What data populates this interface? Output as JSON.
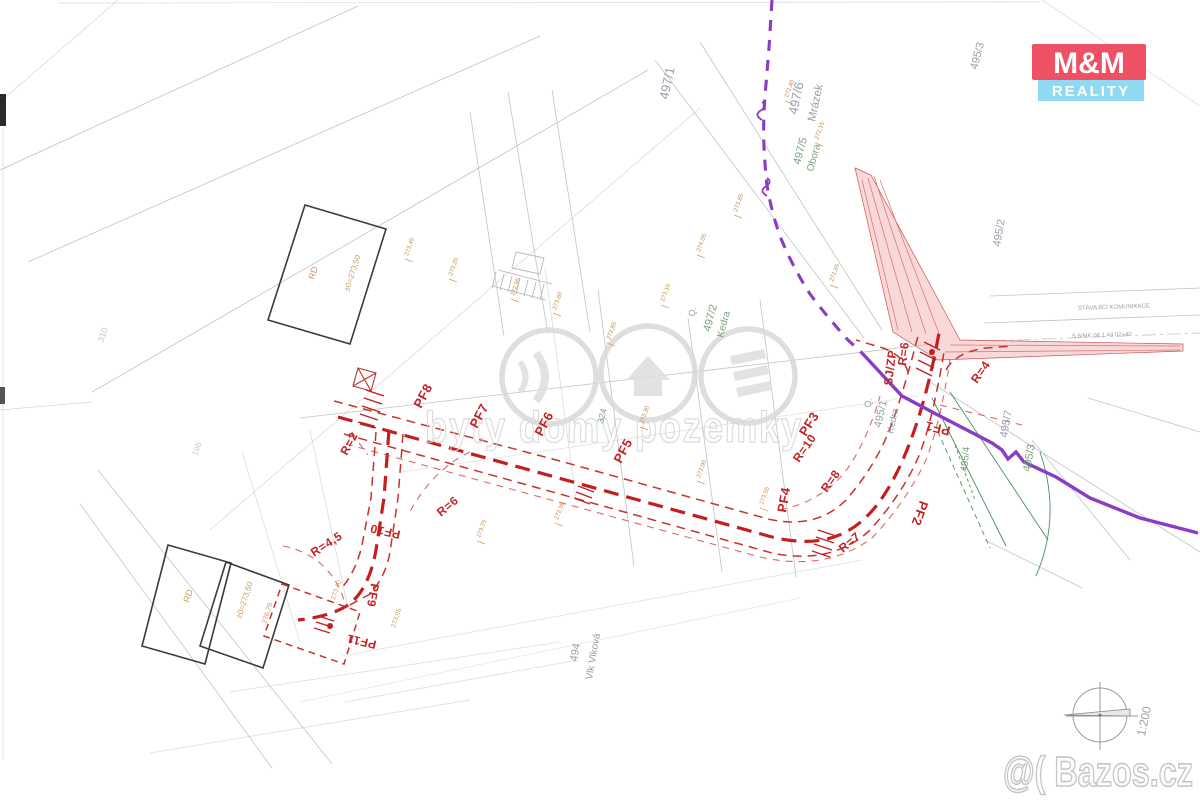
{
  "title": "Scanned cadastral site plan with road design (real-estate listing image)",
  "logo": {
    "line1": "M&M",
    "line2": "REALITY"
  },
  "watermark": {
    "center": "byty domy pozemky",
    "corner": "@( Bazos.cz"
  },
  "scale_label": "1:200",
  "colors": {
    "design_red": "#c41f1f",
    "utility_purple": "#8a3cc2",
    "wedge_pink": "#f0a8a8",
    "vegetation_green": "#4e8d58",
    "parcel_gray": "#98a0ab",
    "logo_red": "#ee5164",
    "logo_cyan": "#8fd9f2"
  },
  "map_labels": {
    "parcel": [
      {
        "t": "497/1",
        "x": 668,
        "y": 100,
        "r": -78,
        "s": 13,
        "c": "lblG"
      },
      {
        "t": "497/6",
        "x": 797,
        "y": 115,
        "r": -78,
        "s": 13,
        "c": "lblG"
      },
      {
        "t": "Mrázek",
        "x": 815,
        "y": 122,
        "r": -78,
        "s": 11.5,
        "c": "lblG"
      },
      {
        "t": "497/5",
        "x": 800,
        "y": 165,
        "r": -75,
        "s": 11,
        "c": "lblGr"
      },
      {
        "t": "Obora",
        "x": 813,
        "y": 172,
        "r": -75,
        "s": 10,
        "c": "lblGr"
      },
      {
        "t": "Q.",
        "x": 694,
        "y": 317,
        "r": -75,
        "s": 9,
        "c": "lblG"
      },
      {
        "t": "497/2",
        "x": 710,
        "y": 332,
        "r": -75,
        "s": 11,
        "c": "lblGr"
      },
      {
        "t": "Kedra",
        "x": 723,
        "y": 338,
        "r": -75,
        "s": 10,
        "c": "lblGr"
      },
      {
        "t": "495/2",
        "x": 1000,
        "y": 247,
        "r": -80,
        "s": 11,
        "c": "lblG"
      },
      {
        "t": "495/3",
        "x": 977,
        "y": 70,
        "r": -75,
        "s": 11,
        "c": "lblG"
      },
      {
        "t": "Q.",
        "x": 870,
        "y": 408,
        "r": -78,
        "s": 9,
        "c": "lblG"
      },
      {
        "t": "495/1",
        "x": 881,
        "y": 428,
        "r": -78,
        "s": 11,
        "c": "lblG"
      },
      {
        "t": "Kedra",
        "x": 893,
        "y": 434,
        "r": -78,
        "s": 9.5,
        "c": "lblG"
      },
      {
        "t": "495/7",
        "x": 1007,
        "y": 438,
        "r": -80,
        "s": 11,
        "c": "lblG"
      },
      {
        "t": "495/3",
        "x": 1030,
        "y": 472,
        "r": -80,
        "s": 11,
        "c": "lblGr"
      },
      {
        "t": "495/4",
        "x": 967,
        "y": 472,
        "r": -84,
        "s": 10,
        "c": "lblGr"
      },
      {
        "t": "494",
        "x": 577,
        "y": 662,
        "r": -80,
        "s": 11,
        "c": "lblG"
      },
      {
        "t": "Vlk Vlková",
        "x": 592,
        "y": 680,
        "r": -80,
        "s": 10,
        "c": "lblG"
      },
      {
        "t": "310",
        "x": 103,
        "y": 343,
        "r": -70,
        "s": 9,
        "c": "lblF"
      },
      {
        "t": "198",
        "x": 197,
        "y": 456,
        "r": -70,
        "s": 8,
        "c": "lblF"
      },
      {
        "t": "324",
        "x": 603,
        "y": 424,
        "r": -75,
        "s": 9,
        "c": "lblGr"
      },
      {
        "t": "STÁVAJÍCÍ KOMUNIKACE",
        "x": 1078,
        "y": 310,
        "r": -2,
        "s": 6,
        "c": "lblG"
      },
      {
        "t": "S 6/MK 08 1 44 02+40",
        "x": 1072,
        "y": 338,
        "r": -2,
        "s": 6,
        "c": "lblG"
      }
    ],
    "design": [
      {
        "t": "PF1",
        "x": 951,
        "y": 427,
        "r": 193,
        "s": 13,
        "c": "lblR"
      },
      {
        "t": "PF2",
        "x": 920,
        "y": 500,
        "r": 110,
        "s": 13,
        "c": "lblR"
      },
      {
        "t": "PF3",
        "x": 806,
        "y": 437,
        "r": -58,
        "s": 13,
        "c": "lblR"
      },
      {
        "t": "PF4",
        "x": 786,
        "y": 513,
        "r": -80,
        "s": 13,
        "c": "lblR"
      },
      {
        "t": "PF5",
        "x": 621,
        "y": 464,
        "r": -62,
        "s": 13,
        "c": "lblR"
      },
      {
        "t": "PF6",
        "x": 542,
        "y": 437,
        "r": -62,
        "s": 13,
        "c": "lblR"
      },
      {
        "t": "PF7",
        "x": 477,
        "y": 429,
        "r": -62,
        "s": 13,
        "c": "lblR"
      },
      {
        "t": "PF8",
        "x": 421,
        "y": 409,
        "r": -62,
        "s": 13,
        "c": "lblR"
      },
      {
        "t": "PF9",
        "x": 371,
        "y": 583,
        "r": 100,
        "s": 12,
        "c": "lblR"
      },
      {
        "t": "PF10",
        "x": 401,
        "y": 531,
        "r": 193,
        "s": 12,
        "c": "lblR"
      },
      {
        "t": "PF11",
        "x": 377,
        "y": 641,
        "r": 193,
        "s": 12,
        "c": "lblR"
      },
      {
        "t": "R=2",
        "x": 347,
        "y": 456,
        "r": -62,
        "s": 12,
        "c": "lblR"
      },
      {
        "t": "R=6",
        "x": 441,
        "y": 517,
        "r": -40,
        "s": 12,
        "c": "lblR"
      },
      {
        "t": "R=4,5",
        "x": 314,
        "y": 557,
        "r": -33,
        "s": 12,
        "c": "lblR"
      },
      {
        "t": "R=10",
        "x": 799,
        "y": 463,
        "r": -55,
        "s": 12,
        "c": "lblR"
      },
      {
        "t": "R=8",
        "x": 827,
        "y": 493,
        "r": -55,
        "s": 12,
        "c": "lblR"
      },
      {
        "t": "R=7",
        "x": 843,
        "y": 553,
        "r": -40,
        "s": 12,
        "c": "lblR"
      },
      {
        "t": "R=4",
        "x": 977,
        "y": 384,
        "r": -55,
        "s": 12,
        "c": "lblR"
      },
      {
        "t": "R=6",
        "x": 906,
        "y": 366,
        "r": -83,
        "s": 12,
        "c": "lblR"
      },
      {
        "t": "SJ/ZP",
        "x": 892,
        "y": 386,
        "r": -83,
        "s": 12,
        "c": "lblR"
      }
    ],
    "building": [
      {
        "t": "RD",
        "x": 314,
        "y": 280,
        "r": -72,
        "s": 9,
        "c": "lblT"
      },
      {
        "t": "±0=273,50",
        "x": 349,
        "y": 292,
        "r": -72,
        "s": 8,
        "c": "lblT"
      },
      {
        "t": "RD",
        "x": 189,
        "y": 603,
        "r": -72,
        "s": 9,
        "c": "lblT"
      },
      {
        "t": "±0=273,50",
        "x": 241,
        "y": 619,
        "r": -72,
        "s": 8,
        "c": "lblT"
      },
      {
        "t": "276,78",
        "x": 266,
        "y": 624,
        "r": -72,
        "s": 7,
        "c": "lblT"
      },
      {
        "t": "273,40",
        "x": 335,
        "y": 600,
        "r": -72,
        "s": 6.5,
        "c": "lblT"
      },
      {
        "t": "273,05",
        "x": 395,
        "y": 628,
        "r": -72,
        "s": 6.5,
        "c": "lblT"
      }
    ],
    "micro": [
      {
        "t": "273,45",
        "x": 408,
        "y": 256,
        "r": -70,
        "s": 6,
        "c": "lblM"
      },
      {
        "t": "273,20",
        "x": 452,
        "y": 276,
        "r": -70,
        "s": 6,
        "c": "lblM"
      },
      {
        "t": "272,95",
        "x": 514,
        "y": 296,
        "r": -70,
        "s": 6,
        "c": "lblM"
      },
      {
        "t": "273,60",
        "x": 556,
        "y": 310,
        "r": -70,
        "s": 6,
        "c": "lblM"
      },
      {
        "t": "272,85",
        "x": 610,
        "y": 340,
        "r": -70,
        "s": 6,
        "c": "lblM"
      },
      {
        "t": "273,10",
        "x": 664,
        "y": 302,
        "r": -70,
        "s": 6,
        "c": "lblM"
      },
      {
        "t": "274,05",
        "x": 700,
        "y": 252,
        "r": -70,
        "s": 6,
        "c": "lblM"
      },
      {
        "t": "273,85",
        "x": 737,
        "y": 212,
        "r": -70,
        "s": 6,
        "c": "lblM"
      },
      {
        "t": "272,40",
        "x": 788,
        "y": 98,
        "r": -70,
        "s": 6,
        "c": "lblM"
      },
      {
        "t": "272,15",
        "x": 818,
        "y": 140,
        "r": -70,
        "s": 6,
        "c": "lblM"
      },
      {
        "t": "272,65",
        "x": 833,
        "y": 282,
        "r": -70,
        "s": 6,
        "c": "lblM"
      },
      {
        "t": "273,30",
        "x": 643,
        "y": 424,
        "r": -70,
        "s": 6,
        "c": "lblM"
      },
      {
        "t": "272,50",
        "x": 558,
        "y": 520,
        "r": -70,
        "s": 6,
        "c": "lblM"
      },
      {
        "t": "273,75",
        "x": 480,
        "y": 538,
        "r": -70,
        "s": 6,
        "c": "lblM"
      },
      {
        "t": "272,90",
        "x": 700,
        "y": 478,
        "r": -70,
        "s": 6,
        "c": "lblM"
      },
      {
        "t": "273,55",
        "x": 763,
        "y": 505,
        "r": -70,
        "s": 6,
        "c": "lblM"
      }
    ]
  }
}
